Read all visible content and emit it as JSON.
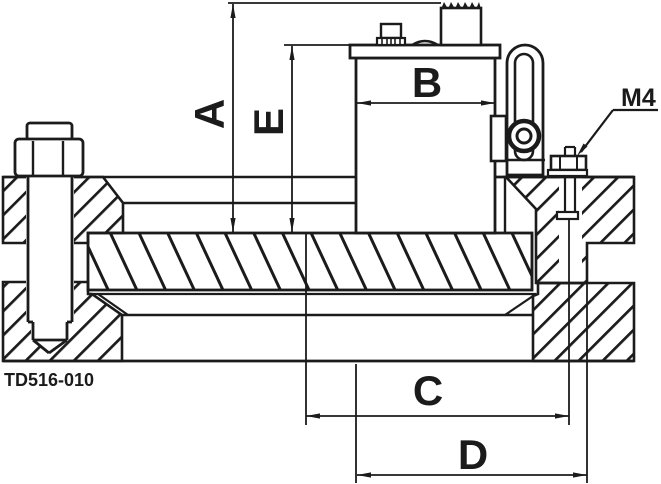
{
  "drawing": {
    "part_number": "TD516-010",
    "dimension_labels": {
      "A": "A",
      "B": "B",
      "C": "C",
      "D": "D",
      "E": "E"
    },
    "thread_label": "M4",
    "line_color": "#1b1b1b",
    "background_color": "#ffffff",
    "view": "sectional front view of toggle clamp assembly bolted between two plates clamping a hatched workpiece bar"
  }
}
